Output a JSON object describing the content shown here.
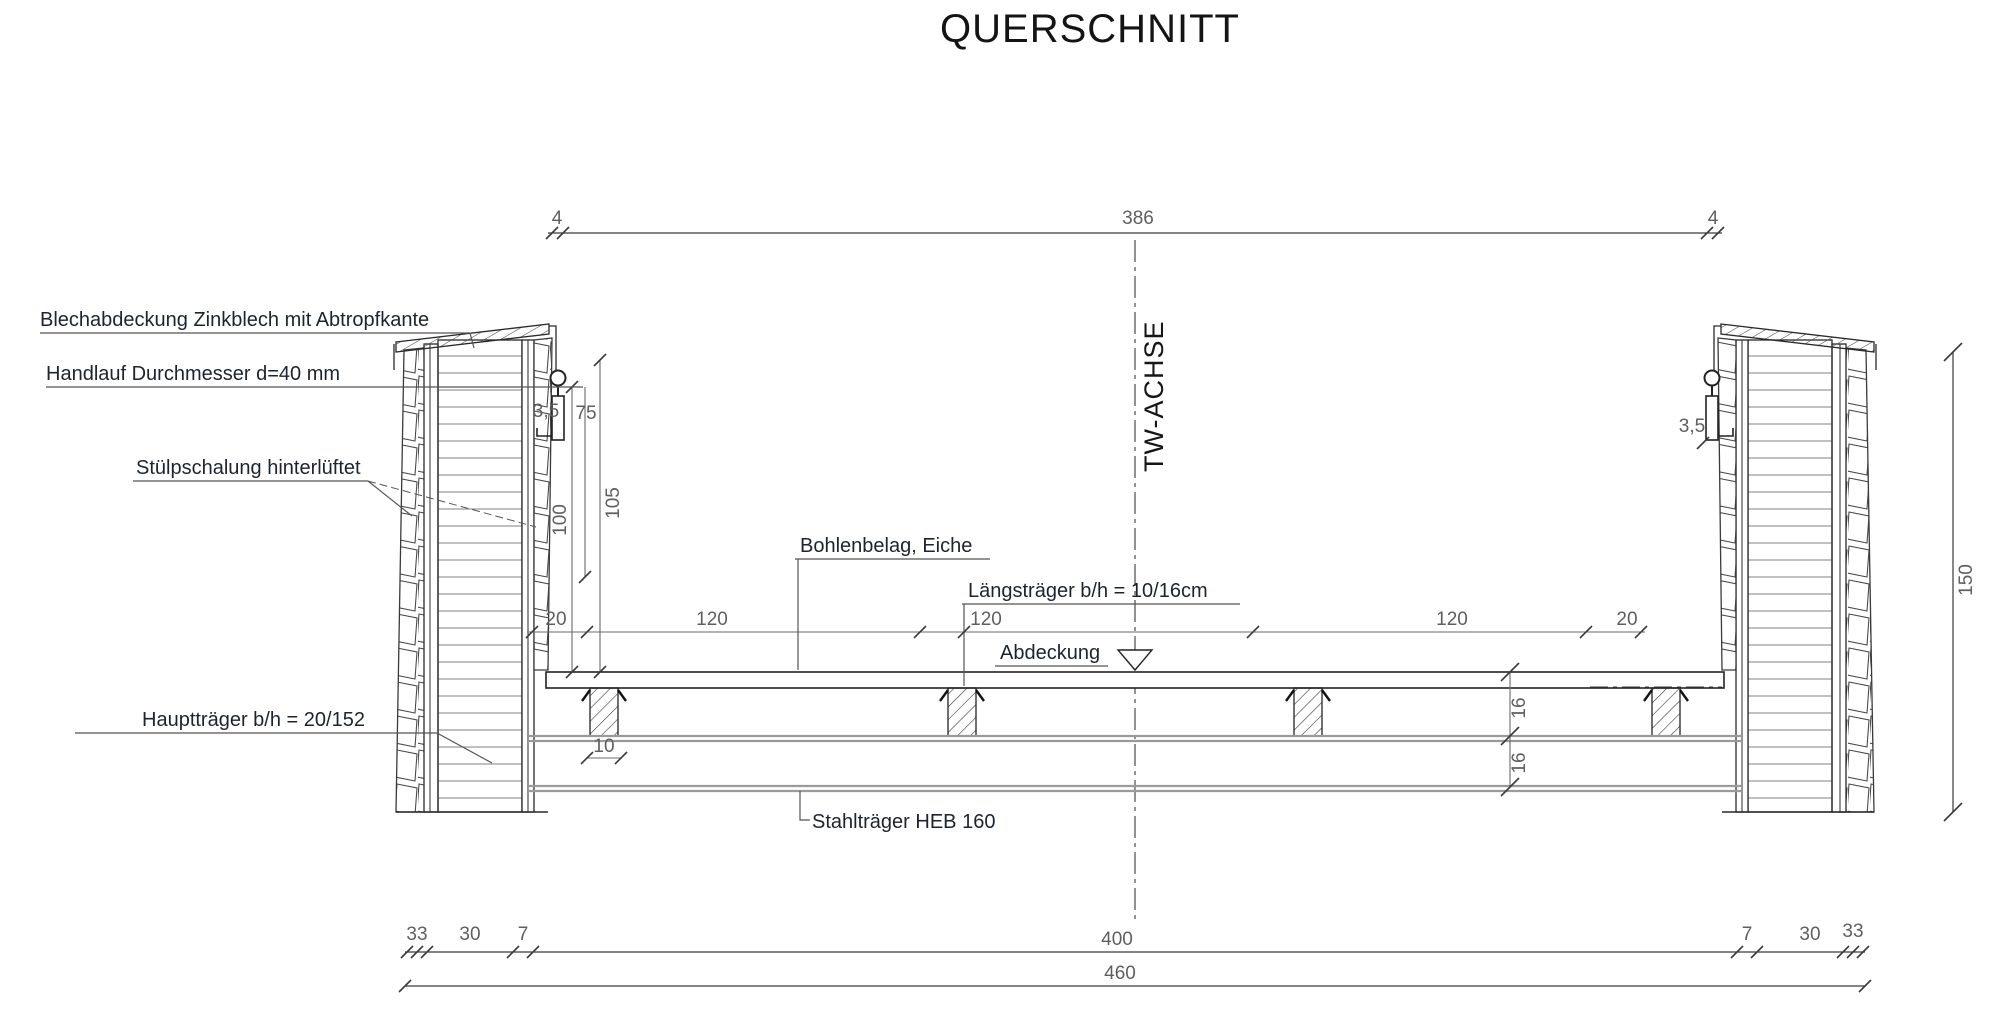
{
  "title": "QUERSCHNITT",
  "axis": {
    "label": "TW-ACHSE"
  },
  "labels": {
    "blechabdeckung": "Blechabdeckung Zinkblech mit Abtropfkante",
    "handlauf": "Handlauf Durchmesser d=40 mm",
    "stuelpschalung": "Stülpschalung hinterlüftet",
    "haupttraeger": "Hauptträger b/h = 20/152",
    "bohlenbelag": "Bohlenbelag, Eiche",
    "laengstraeger": "Längsträger b/h = 10/16cm",
    "abdeckung": "Abdeckung",
    "stahltraeger": "Stahlträger HEB 160"
  },
  "dims": {
    "top": {
      "left": "4",
      "span": "386",
      "right": "4"
    },
    "deck": [
      "20",
      "120",
      "120",
      "120",
      "20"
    ],
    "rail_offset_left": "3,5",
    "rail_height": "75",
    "deck_height_inner": "100",
    "deck_height_outer": "105",
    "joist_width": "10",
    "rail_offset_right": "3,5",
    "beam_gap_top": "16",
    "beam_gap_bottom": "16",
    "tower_height": "150",
    "bottom": [
      "33",
      "30",
      "7",
      "400",
      "7",
      "30",
      "33"
    ],
    "total": "460"
  },
  "colors": {
    "line": "#2a2a2a",
    "dim_line": "#6a6a6a",
    "dim_text": "#5f5f5f",
    "label_text": "#1c2430",
    "beam_gray": "#9a9a9a",
    "background": "#ffffff"
  }
}
